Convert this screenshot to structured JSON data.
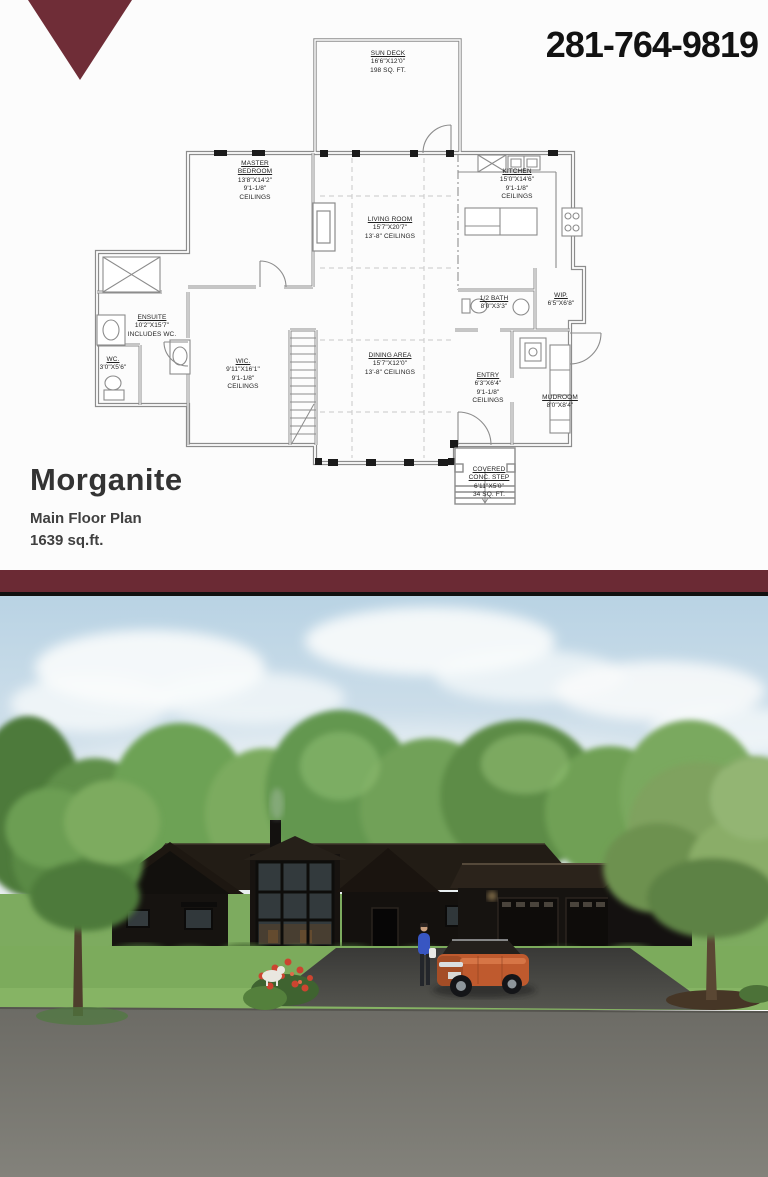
{
  "brand": {
    "color": "#6b2a34",
    "logo": "maroon-triangle-banner"
  },
  "header": {
    "phone": "281-764-9819"
  },
  "plan": {
    "title": "Morganite",
    "subtitle": "Main Floor Plan",
    "area": "1639 sq.ft.",
    "rooms": {
      "sun_deck": {
        "name": "SUN DECK",
        "dims": "16'6\"X12'0\"",
        "note": "198 SQ. FT."
      },
      "master_bedroom": {
        "name": "MASTER",
        "name2": "BEDROOM",
        "dims": "13'8\"X14'2\"",
        "note": "9'1-1/8\"",
        "note2": "CEILINGS"
      },
      "living_room": {
        "name": "LIVING ROOM",
        "dims": "15'7\"X20'7\"",
        "note": "13'-8\" CEILINGS"
      },
      "kitchen": {
        "name": "KITCHEN",
        "dims": "15'0\"X14'6\"",
        "note": "9'1-1/8\"",
        "note2": "CEILINGS"
      },
      "ensuite": {
        "name": "ENSUITE",
        "dims": "10'2\"X15'7\"",
        "note": "INCLUDES WC."
      },
      "wc": {
        "name": "WC.",
        "dims": "3'0\"X5'6\""
      },
      "wic": {
        "name": "WIC.",
        "dims": "9'11\"X16'1\"",
        "note": "9'1-1/8\"",
        "note2": "CEILINGS"
      },
      "dining_area": {
        "name": "DINING AREA",
        "dims": "15'7\"X12'0\"",
        "note": "13'-8\" CEILINGS"
      },
      "half_bath": {
        "name": "1/2 BATH",
        "dims": "8'0\"X3'3\""
      },
      "wip": {
        "name": "WIP.",
        "dims": "6'5\"X6'8\""
      },
      "entry": {
        "name": "ENTRY",
        "dims": "6'3\"X6'4\"",
        "note": "9'1-1/8\"",
        "note2": "CEILINGS"
      },
      "mudroom": {
        "name": "MUDROOM",
        "dims": "8'0\"X8'4\""
      },
      "covered_step": {
        "name": "COVERED",
        "name2": "CONC. STEP",
        "dims": "6'11\"X5'0\"",
        "note": "34 SQ. FT."
      }
    }
  },
  "render_colors": {
    "sky": "#c3d9e7",
    "trees": "#6f9e55",
    "house": "#171310",
    "roof": "#241d16",
    "lawn": "#7cab5c",
    "driveway": "#454543",
    "road": "#76756f",
    "car": "#bf5a2e"
  }
}
